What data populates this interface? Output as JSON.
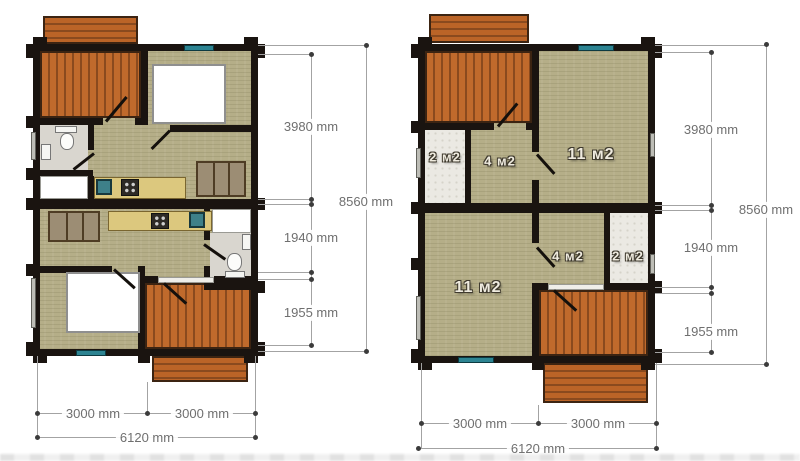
{
  "left_plan": {
    "side_dims": {
      "segment_top": "3980 mm",
      "segment_mid": "1940 mm",
      "segment_bottom": "1955 mm",
      "total": "8560 mm"
    },
    "bottom_dims": {
      "left": "3000 mm",
      "right": "3000 mm",
      "total": "6120 mm"
    }
  },
  "right_plan": {
    "rooms": {
      "top_small": "2 м2",
      "top_mid": "4 м2",
      "top_large": "11 м2",
      "bottom_large": "11 м2",
      "bottom_mid": "4 м2",
      "bottom_small": "2 м2"
    },
    "side_dims": {
      "segment_top": "3980 mm",
      "segment_mid": "1940 mm",
      "segment_bottom": "1955 mm",
      "total": "8560 mm"
    },
    "bottom_dims": {
      "left": "3000 mm",
      "right": "3000 mm",
      "total": "6120 mm"
    }
  },
  "colors": {
    "wall": "#1a1410",
    "floor": "#b5ae88",
    "deck": "#c06a2c",
    "deck_stripe": "#8a4a1e",
    "window": "#2d8492",
    "tile_floor": "#ebe9e3",
    "counter": "#dcc87e",
    "dimension_text": "#6f6f6f",
    "dimension_line": "#a3a3a3"
  }
}
